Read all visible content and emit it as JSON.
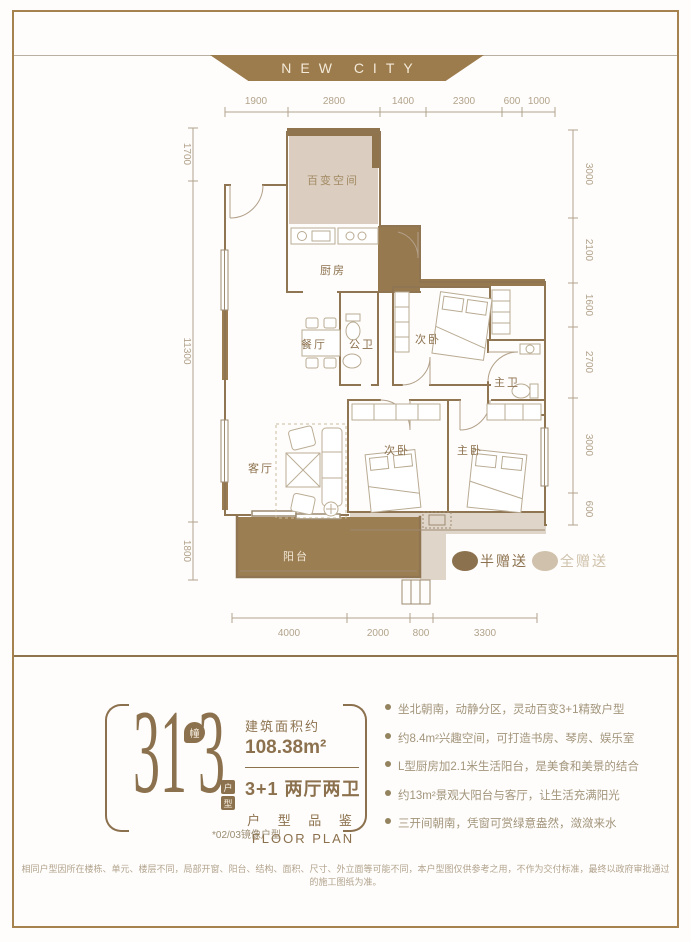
{
  "meta": {
    "brand": "NEW CITY"
  },
  "colors": {
    "frame": "#a6824f",
    "banner_bg": "#9c7b4c",
    "accent_dark": "#8c714e",
    "gift_half": "#9c7e53",
    "gift_full": "#d9cdbb",
    "dim_text": "#b2a38c"
  },
  "plan": {
    "rooms": [
      "百变空间",
      "厨房",
      "餐厅",
      "公卫",
      "次卧",
      "主卫",
      "客厅",
      "次卧",
      "主卧",
      "阳台"
    ],
    "dims_top": [
      "1900",
      "2800",
      "1400",
      "2300",
      "600",
      "1000"
    ],
    "dims_left": [
      "1700",
      "11300",
      "1800"
    ],
    "dims_right": [
      "3000",
      "2100",
      "1600",
      "2700",
      "3000",
      "600"
    ],
    "dims_bottom": [
      "4000",
      "2000",
      "800",
      "3300"
    ],
    "legend": [
      {
        "label": "半赠送",
        "color": "#8c714e"
      },
      {
        "label": "全赠送",
        "color": "#cfc1ab"
      }
    ]
  },
  "info": {
    "building_no": "31",
    "building_unit": "幢",
    "unit_no": "3",
    "unit_suffix": [
      "户",
      "型"
    ],
    "area_label": "建筑面积约",
    "area_value": "108.38m²",
    "layout_label": "3+1 两厅两卫",
    "series_cn": "户 型 品 鉴",
    "series_en": "FLOOR PLAN",
    "mirror_note": "*02/03镜像户型",
    "features": [
      "坐北朝南，动静分区，灵动百变3+1精致户型",
      "约8.4m²兴趣空间，可打造书房、琴房、娱乐室",
      "L型厨房加2.1米生活阳台，是美食和美景的结合",
      "约13m²景观大阳台与客厅，让生活充满阳光",
      "三开间朝南，凭窗可赏绿意盎然，潋潋来水"
    ]
  },
  "disclaimer": "相同户型因所在楼栋、单元、楼层不同，局部开窗、阳台、结构、面积、尺寸、外立面等可能不同，本户型图仅供参考之用，不作为交付标准，最终以政府审批通过的施工图纸为准。"
}
